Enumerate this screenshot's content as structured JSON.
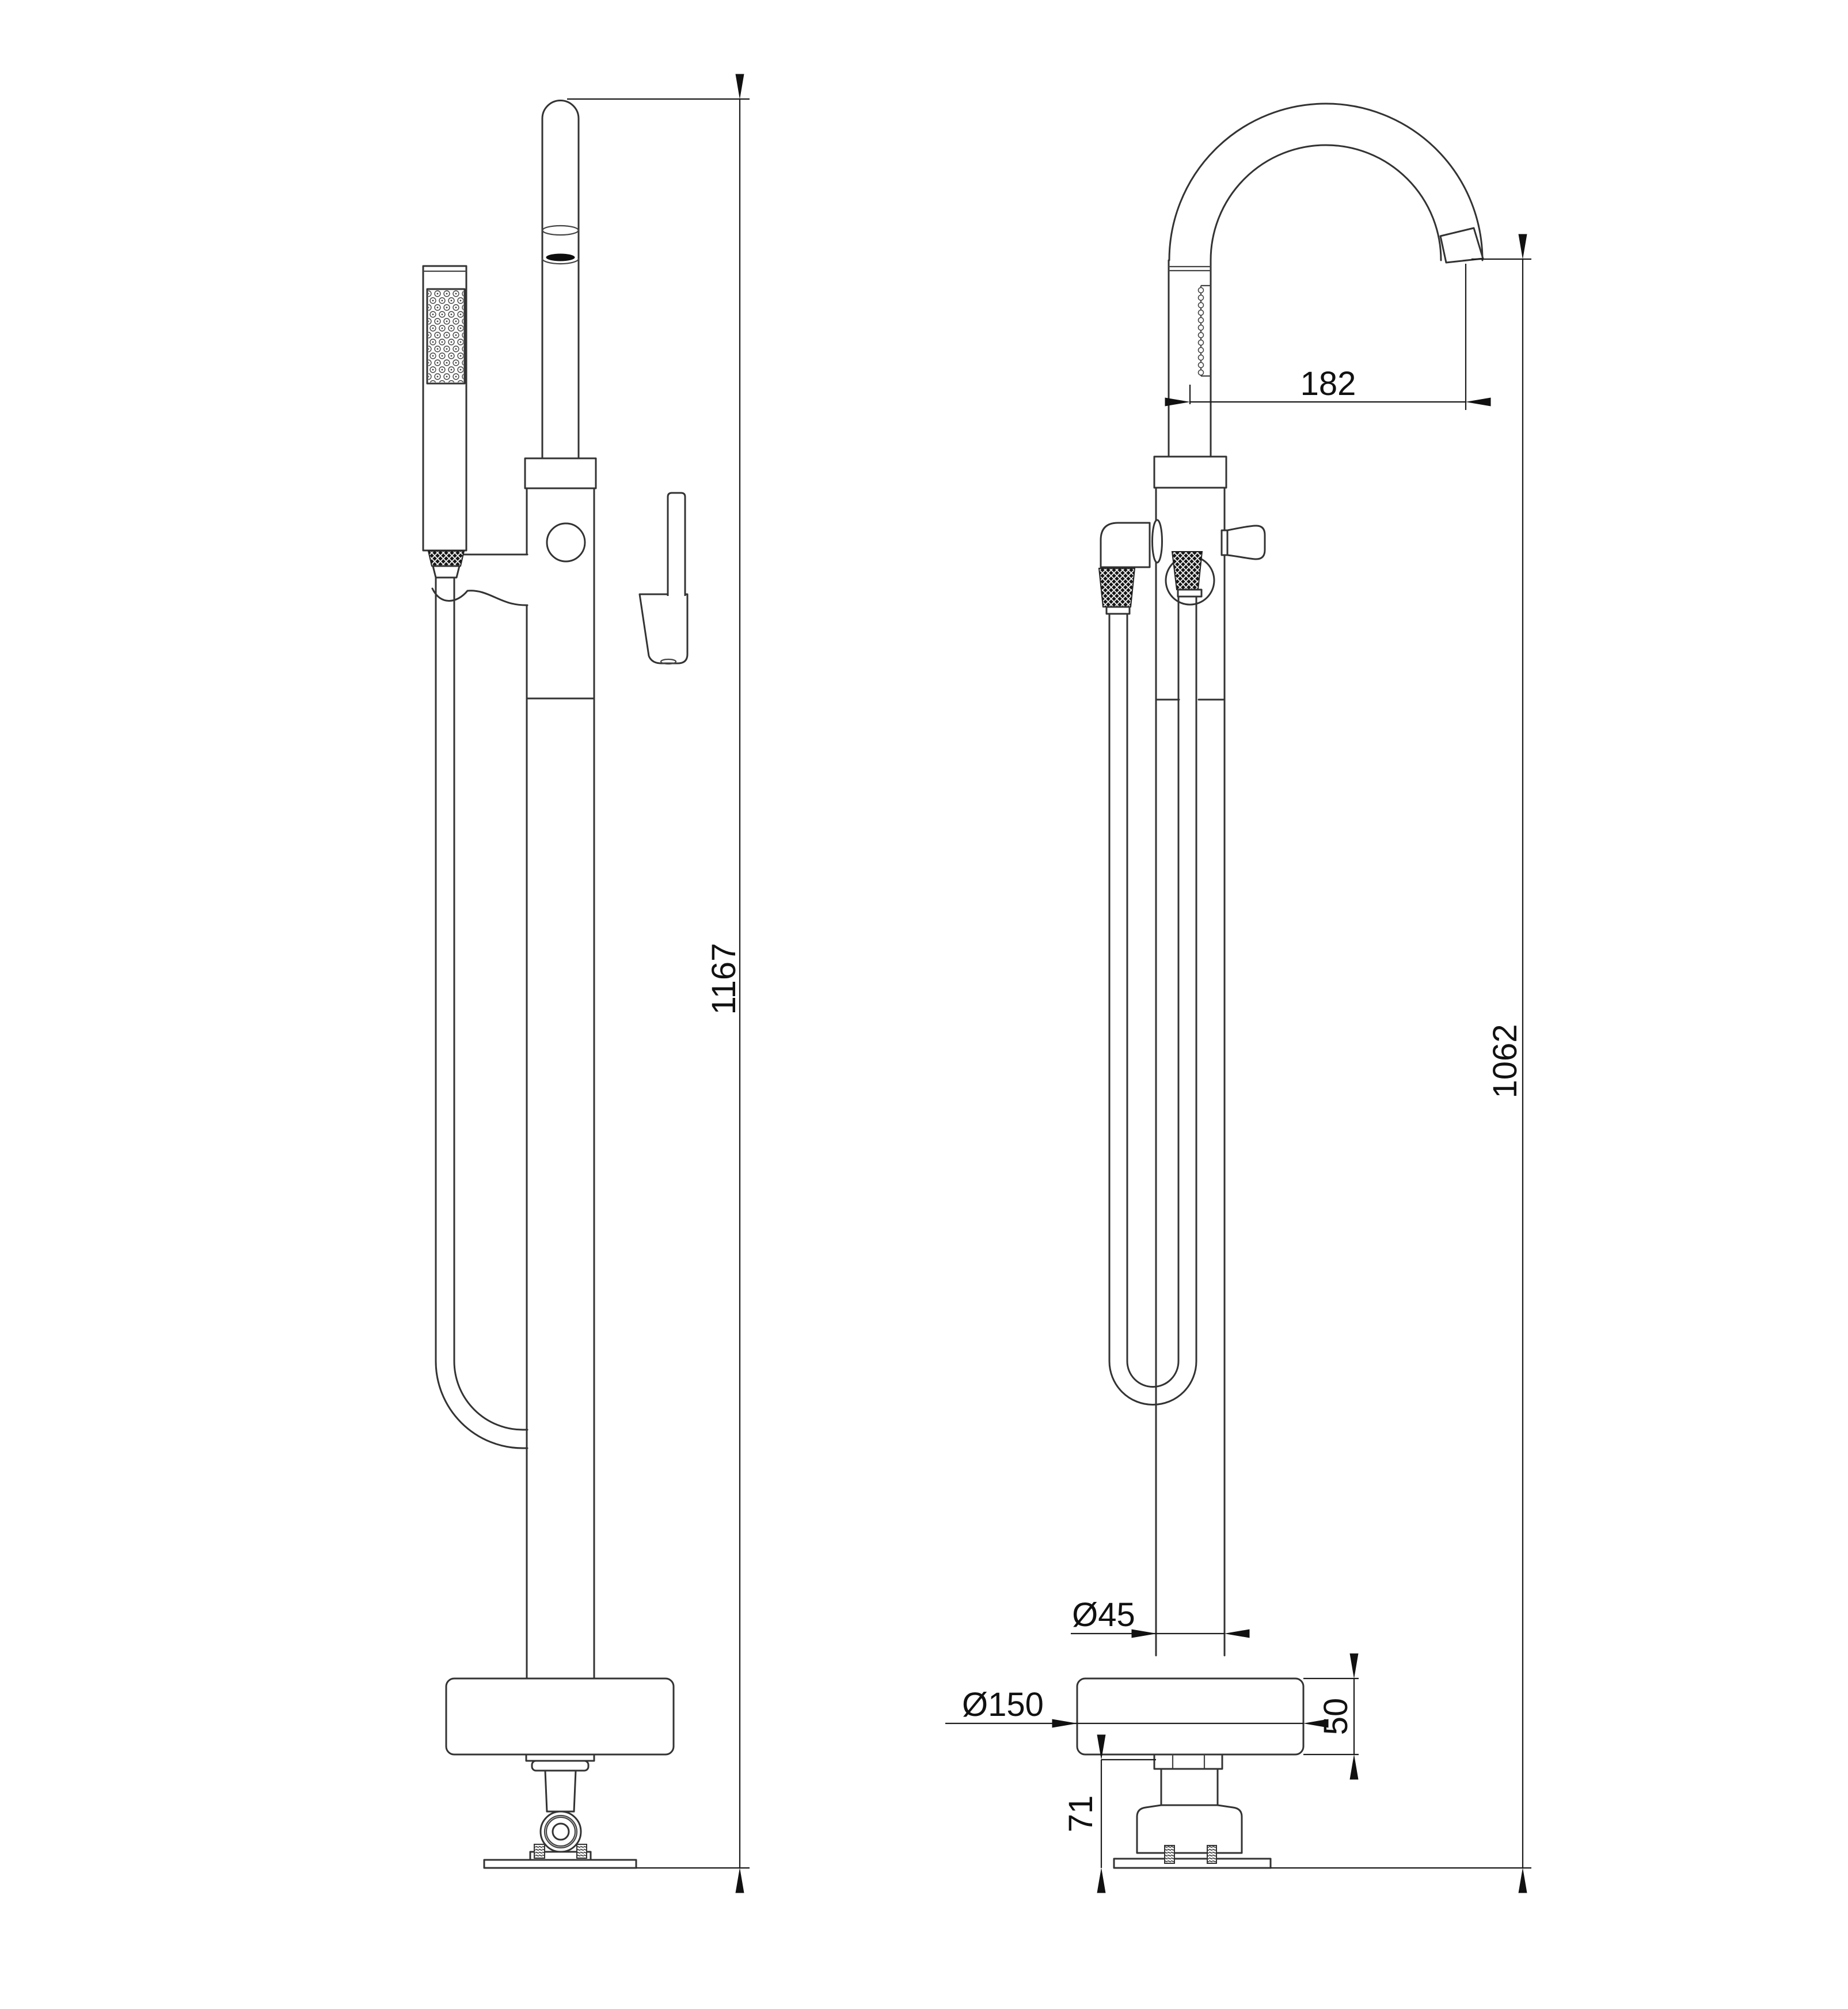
{
  "drawing": {
    "type": "technical-dimension-drawing",
    "subject": "freestanding-bath-shower-mixer",
    "background_color": "#ffffff",
    "line_color": "#333333",
    "dimension_color": "#1c1c1c",
    "views": [
      {
        "id": "front",
        "name": "front-view"
      },
      {
        "id": "side",
        "name": "side-view"
      }
    ]
  },
  "dimensions": {
    "front_total_height": "1167",
    "spout_reach": "182",
    "outlet_height": "1062",
    "column_diameter": "Ø45",
    "base_diameter": "Ø150",
    "base_thickness": "50",
    "floor_fitting_depth": "71"
  }
}
